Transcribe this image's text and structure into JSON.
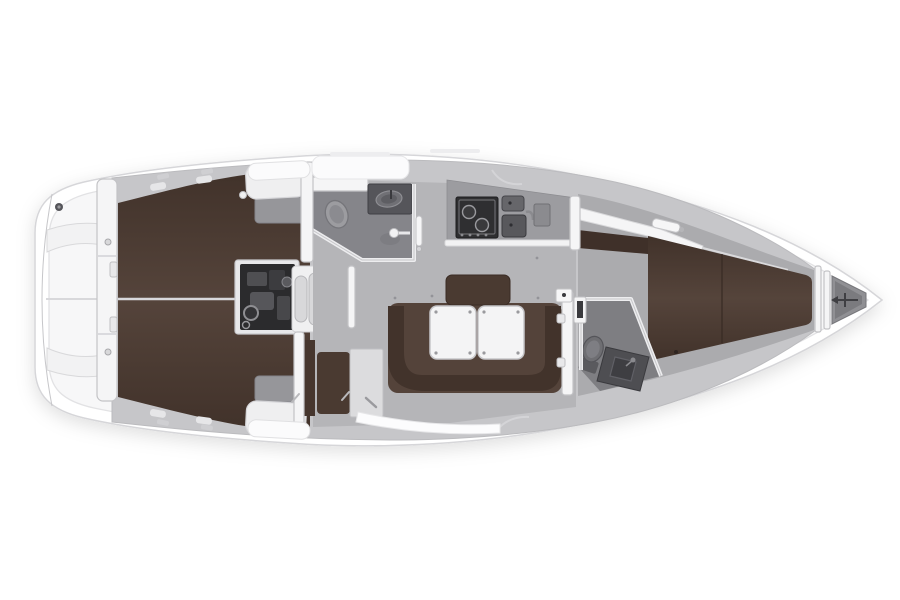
{
  "diagram": {
    "type": "sailboat-interior-floor-plan",
    "view": "top-down",
    "bow_direction": "right",
    "regions": [
      {
        "id": "stern-lazarette",
        "label": "stern lazarette lockers"
      },
      {
        "id": "aft-cabin",
        "label": "aft double berth cabin"
      },
      {
        "id": "engine-compartment",
        "label": "engine compartment"
      },
      {
        "id": "companionway-steps",
        "label": "companionway steps"
      },
      {
        "id": "aft-head",
        "label": "aft head with toilet, sink and shower"
      },
      {
        "id": "galley",
        "label": "galley with stove and twin sinks"
      },
      {
        "id": "saloon",
        "label": "saloon with U-settee and folding tables"
      },
      {
        "id": "nav-seat",
        "label": "navigation seat and chart table"
      },
      {
        "id": "forward-head",
        "label": "forward head with toilet and vanity"
      },
      {
        "id": "forward-cabin",
        "label": "forward V-berth cabin"
      },
      {
        "id": "anchor-locker",
        "label": "anchor locker"
      }
    ]
  },
  "colors": {
    "background": "#ffffff",
    "hull_fill": "#ffffff",
    "hull_stroke": "#d6d6d9",
    "deck_fill": "#f7f7f8",
    "interior_base": "#c6c6c9",
    "saloon_floor": "#b5b5b8",
    "walkway_gray": "#ababae",
    "head_floor": "#85858a",
    "fwd_head_floor": "#7e7e82",
    "berth_brown": "#55443b",
    "berth_brown_edge": "#41322a",
    "berth_shelf_brown": "#3f3029",
    "settee_brown": "#54433a",
    "settee_band_brown": "#42332b",
    "backrest_brown": "#4a3a31",
    "nav_seat_brown": "#4a3a31",
    "wardrobe_brown": "#46362e",
    "cushion_white": "#efeff0",
    "cushion_gray": "#96969a",
    "table_white": "#f4f4f5",
    "counter_gray": "#9c9ca0",
    "stove_black": "#2f2f31",
    "sink_gray": "#58585c",
    "vanity_gray": "#55555a",
    "fwd_vanity_gray": "#4e4e52",
    "toilet_gray": "#9c9ca0",
    "fwd_toilet_gray": "#6e6e72",
    "engine_black": "#2b2b2d",
    "step_gray": "#d8d8da",
    "chart_panel_gray": "#dcdcde",
    "anchor_locker_gray": "#909094",
    "seam_light": "#d8d8db"
  }
}
